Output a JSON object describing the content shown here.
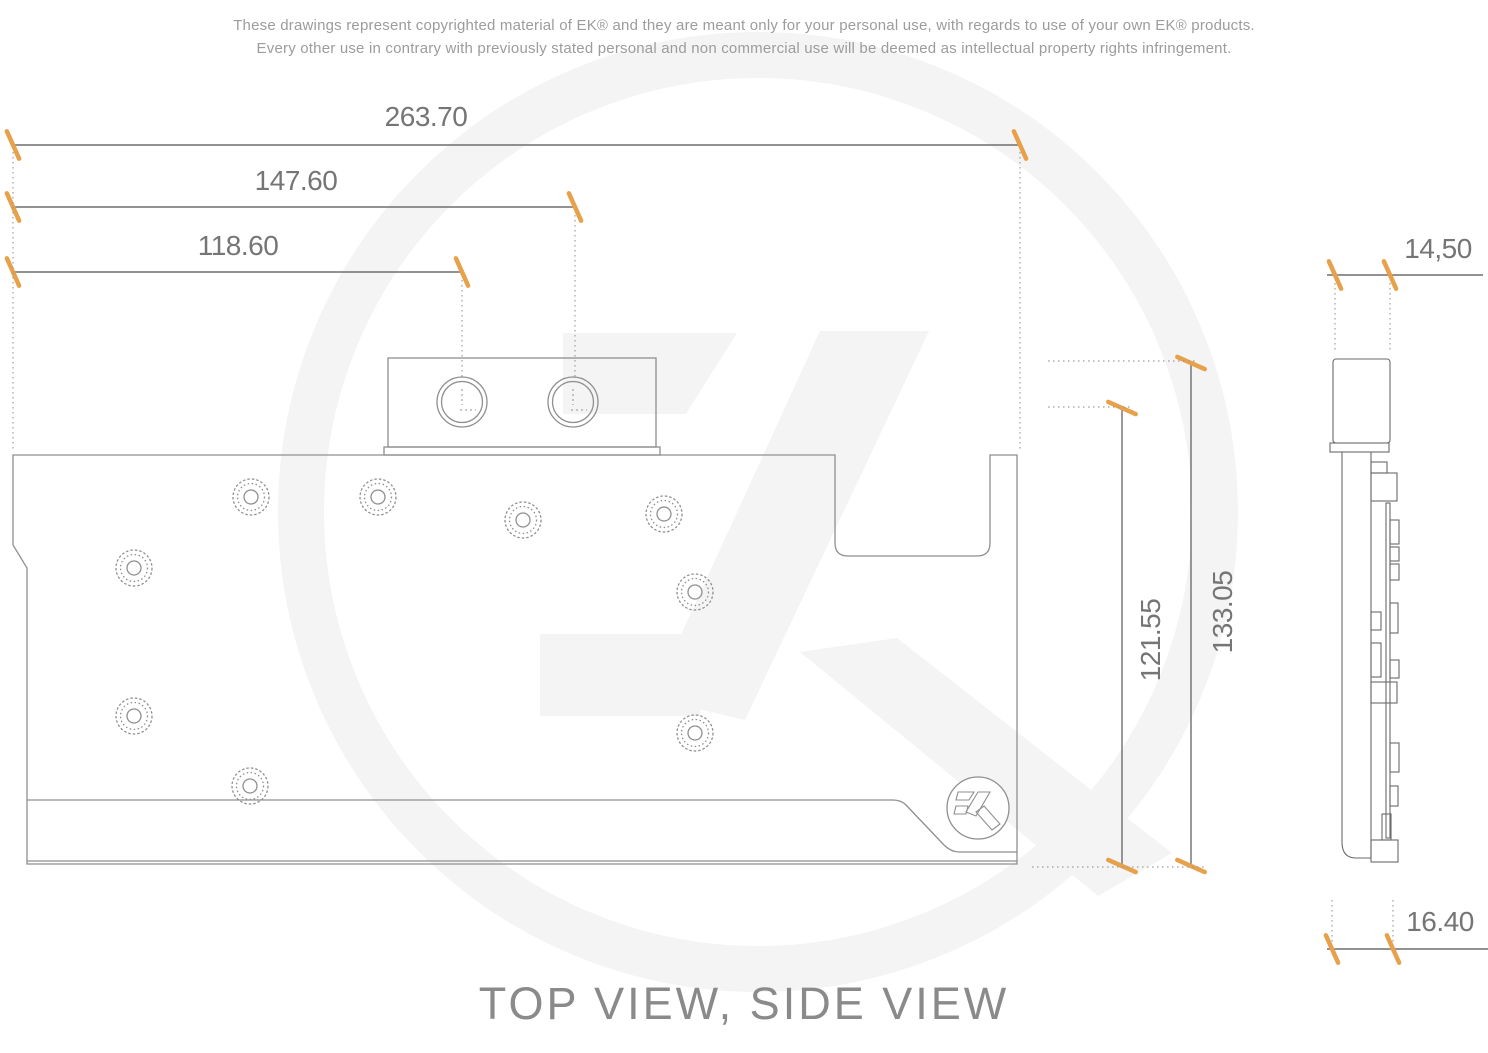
{
  "disclaimer": {
    "line1": "These drawings represent copyrighted material of EK® and they are meant only for your personal use, with regards to use of your own EK® products.",
    "line2": "Every other use in contrary with previously stated personal and non commercial use will be deemed as intellectual property rights infringement."
  },
  "title": "TOP VIEW, SIDE VIEW",
  "dimensions": {
    "total_width": "263.70",
    "port2_offset": "147.60",
    "port1_offset": "118.60",
    "top_thickness": "14,50",
    "pcb_height": "121.55",
    "total_height": "133.05",
    "bottom_thickness": "16.40"
  },
  "colors": {
    "tick_orange": "#E8A14B",
    "drawing_line": "#8F8F8F",
    "side_view_line": "#6A6A6A",
    "dimension_line": "#6E6E6E",
    "leader_dots": "#9C9C9C",
    "label_text": "#757575",
    "title_text": "#8A8A8A",
    "watermark": "#F4F4F4"
  }
}
